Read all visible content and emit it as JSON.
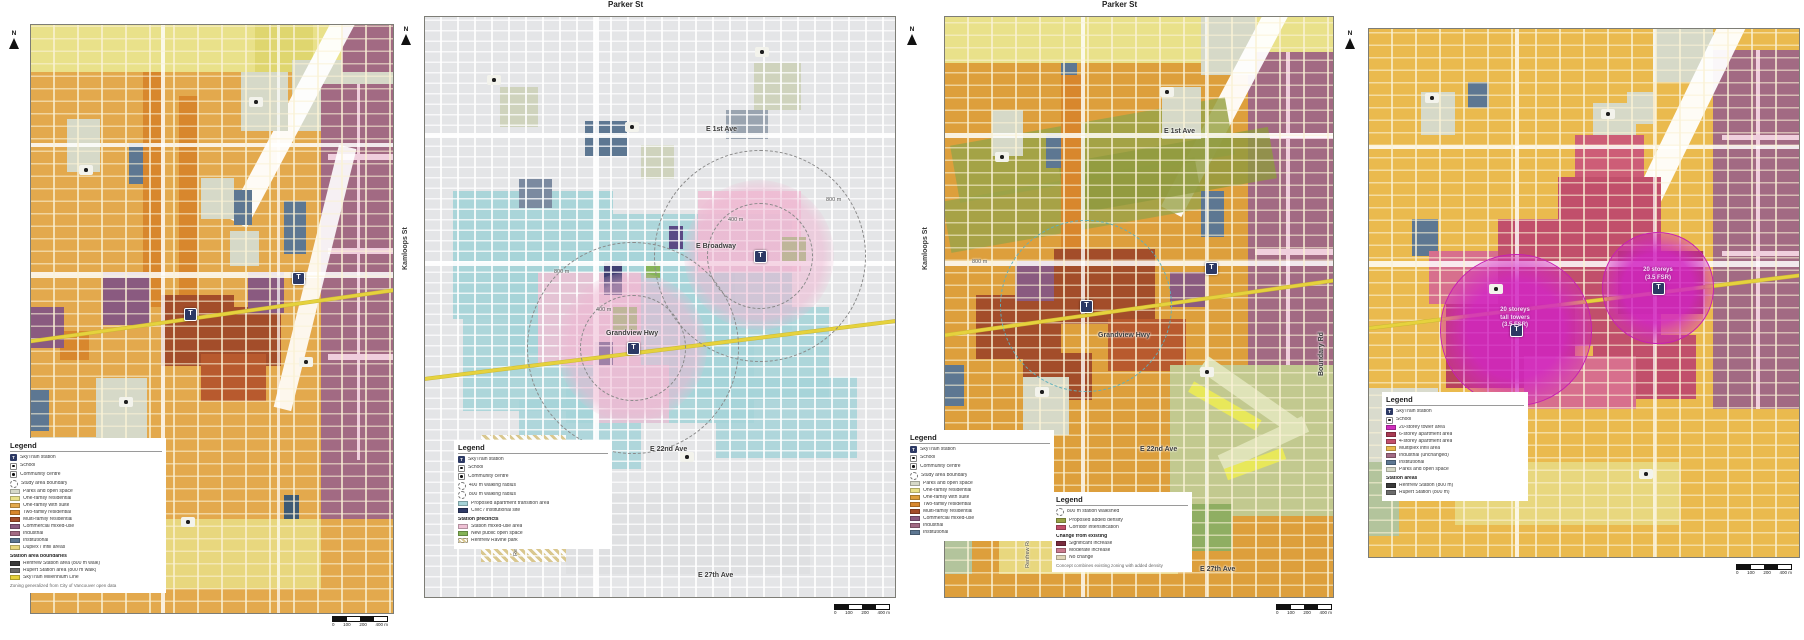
{
  "north_label": "N",
  "station_label": "T",
  "scale": {
    "t0": "0",
    "t1": "100",
    "t2": "200",
    "t3": "400 m"
  },
  "colors": {
    "skytrain_line": "#e6d23d",
    "station_icon": "#2c3964",
    "single_family": "#e3a94d",
    "teal_proposed": "#a6d4d8",
    "industrial_mauve": "#a26a83",
    "multi_family_red": "#a34d2a",
    "tower_magenta": "#cf2ebc",
    "apartment_crimson": "#c14f6b",
    "density_olive": "#9aa348",
    "park_gray": "#d6d9c8"
  },
  "maps": [
    {
      "id": "existing-zoning",
      "labels": [],
      "legend": {
        "title": "Legend",
        "items": [
          {
            "icon": "station",
            "label": "SkyTrain station"
          },
          {
            "icon": "dot",
            "label": "School"
          },
          {
            "icon": "dot",
            "label": "Community centre"
          },
          {
            "icon": "dash",
            "label": "Study area boundary"
          },
          {
            "color": "#d6d9c8",
            "label": "Parks and open space"
          },
          {
            "color": "#e9e18a",
            "label": "One-family residential"
          },
          {
            "color": "#e3a94d",
            "label": "One-family with suite"
          },
          {
            "color": "#d8872d",
            "label": "Two-family residential"
          },
          {
            "color": "#a34d2a",
            "label": "Multi-family residential"
          },
          {
            "color": "#8a5a80",
            "label": "Commercial mixed-use"
          },
          {
            "color": "#a26a83",
            "label": "Industrial"
          },
          {
            "color": "#5d7792",
            "label": "Institutional"
          },
          {
            "color": "#e8d77e",
            "label": "Duplex / infill areas"
          },
          {
            "kind": "sub",
            "label": "Station area boundaries"
          },
          {
            "color": "#3a3a3a",
            "label": "Renfrew Station area (800 m walk)"
          },
          {
            "color": "#6b6b6b",
            "label": "Rupert Station area (800 m walk)"
          },
          {
            "color": "#e6d23d",
            "label": "SkyTrain Millennium Line"
          }
        ],
        "footnote": "Zoning generalized from City of Vancouver open data"
      }
    },
    {
      "id": "station-area-concept",
      "labels": [
        {
          "text": "Parker St",
          "cls": "big",
          "style": "left:210px;top:1px;"
        },
        {
          "text": "Kamloops St",
          "cls": "vert",
          "style": "left:12px;top:262px;"
        },
        {
          "text": "E 1st Ave",
          "style": "left:308px;top:126px;"
        },
        {
          "text": "E Broadway",
          "style": "left:298px;top:243px;"
        },
        {
          "text": "Grandview Hwy",
          "style": "left:208px;top:330px;"
        },
        {
          "text": "E 22nd Ave",
          "style": "left:252px;top:446px;"
        },
        {
          "text": "E 27th Ave",
          "style": "left:300px;top:572px;"
        },
        {
          "text": "Renfrew Ravine",
          "cls": "vert small",
          "style": "left:122px;top:548px;"
        },
        {
          "text": "800 m",
          "cls": "small",
          "style": "left:156px;top:268px;"
        },
        {
          "text": "400 m",
          "cls": "small",
          "style": "left:198px;top:306px;"
        },
        {
          "text": "800 m",
          "cls": "small",
          "style": "left:428px;top:196px;"
        },
        {
          "text": "400 m",
          "cls": "small",
          "style": "left:330px;top:216px;"
        }
      ],
      "legend": {
        "title": "Legend",
        "items": [
          {
            "icon": "station",
            "label": "SkyTrain station"
          },
          {
            "icon": "dot",
            "label": "School"
          },
          {
            "icon": "dot",
            "label": "Community centre"
          },
          {
            "icon": "dash",
            "label": "400 m walking radius"
          },
          {
            "icon": "dash",
            "label": "800 m walking radius"
          },
          {
            "color": "#a6d4d8",
            "label": "Proposed apartment transition area"
          },
          {
            "color": "#2e3a66",
            "label": "Civic / institutional site"
          },
          {
            "kind": "sub",
            "label": "Station precincts"
          },
          {
            "color": "#eec0d4",
            "label": "Station mixed-use area"
          },
          {
            "color": "#85b457",
            "label": "New public open space"
          },
          {
            "icon": "hatch",
            "label": "Renfrew Ravine park"
          }
        ],
        "footnote": ""
      }
    },
    {
      "id": "combined-concept",
      "labels": [
        {
          "text": "Parker St",
          "cls": "big",
          "style": "left:200px;top:1px;"
        },
        {
          "text": "Kamloops St",
          "cls": "vert",
          "style": "left:28px;top:262px;"
        },
        {
          "text": "E 1st Ave",
          "style": "left:262px;top:128px;"
        },
        {
          "text": "Grandview Hwy",
          "style": "left:196px;top:332px;"
        },
        {
          "text": "E 22nd Ave",
          "style": "left:238px;top:446px;"
        },
        {
          "text": "E 27th Ave",
          "style": "left:298px;top:566px;"
        },
        {
          "text": "Renfrew Ravine",
          "cls": "vert small",
          "style": "left:130px;top:560px;"
        },
        {
          "text": "Boundary Rd",
          "cls": "vert",
          "style": "left:424px;top:368px;"
        },
        {
          "text": "800 m",
          "cls": "small",
          "style": "left:70px;top:258px;"
        }
      ],
      "legend": {
        "title": "Legend",
        "items": [
          {
            "icon": "station",
            "label": "SkyTrain station"
          },
          {
            "icon": "dot",
            "label": "School"
          },
          {
            "icon": "dot",
            "label": "Community centre"
          },
          {
            "icon": "dash",
            "label": "Study area boundary"
          },
          {
            "color": "#d6d9c8",
            "label": "Parks and open space"
          },
          {
            "color": "#e9e18a",
            "label": "One-family residential"
          },
          {
            "color": "#dd9f3c",
            "label": "One-family with suite"
          },
          {
            "color": "#d8872d",
            "label": "Two-family residential"
          },
          {
            "color": "#a34d2a",
            "label": "Multi-family residential"
          },
          {
            "color": "#8a5a80",
            "label": "Commercial mixed-use"
          },
          {
            "color": "#a26a83",
            "label": "Industrial"
          },
          {
            "color": "#5d7792",
            "label": "Institutional"
          }
        ],
        "footnote": ""
      },
      "legend2": {
        "title": "Legend",
        "items": [
          {
            "icon": "dash",
            "label": "800 m station walkshed"
          },
          {
            "color": "#9aa348",
            "label": "Proposed added density"
          },
          {
            "color": "#c14f6b",
            "label": "Corridor intensification"
          },
          {
            "kind": "sub",
            "label": "Change from existing"
          },
          {
            "color": "#7a2d3f",
            "label": "Significant increase"
          },
          {
            "color": "#c97a8d",
            "label": "Moderate increase"
          },
          {
            "color": "#e0d6b8",
            "label": "No change"
          }
        ],
        "footnote": "Concept combines existing zoning with added density"
      }
    },
    {
      "id": "tower-concept",
      "labels": [],
      "station_notes": {
        "left": [
          "20 storeys",
          "tall towers",
          "(3.5 FSR)"
        ],
        "right": [
          "20 storeys",
          "(3.5 FSR)"
        ]
      },
      "legend": {
        "title": "Legend",
        "items": [
          {
            "icon": "station",
            "label": "SkyTrain station"
          },
          {
            "icon": "dot",
            "label": "School"
          },
          {
            "color": "#cf2ebc",
            "label": "20-storey tower area"
          },
          {
            "color": "#a83a52",
            "label": "6-storey apartment area"
          },
          {
            "color": "#c14f6b",
            "label": "4-storey apartment area"
          },
          {
            "color": "#eaba4e",
            "label": "Multiplex infill area"
          },
          {
            "color": "#a26a83",
            "label": "Industrial (unchanged)"
          },
          {
            "color": "#5d7792",
            "label": "Institutional"
          },
          {
            "color": "#d6d9c8",
            "label": "Parks and open space"
          },
          {
            "kind": "sub",
            "label": "Station areas"
          },
          {
            "color": "#3a3a3a",
            "label": "Renfrew Station (800 m)"
          },
          {
            "color": "#6b6b6b",
            "label": "Rupert Station (800 m)"
          }
        ],
        "footnote": ""
      }
    }
  ]
}
